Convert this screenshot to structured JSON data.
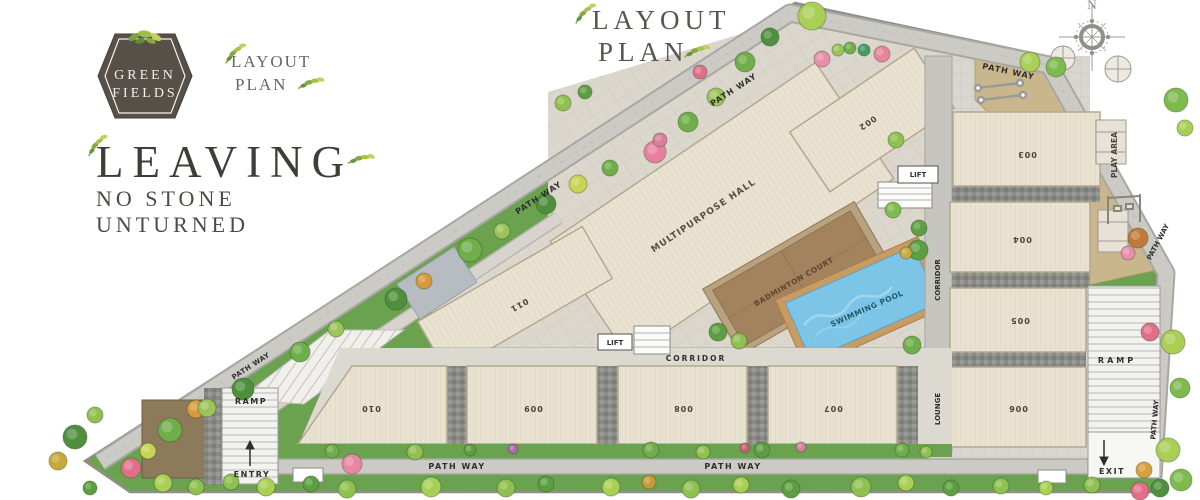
{
  "branding": {
    "logo_line1": "GREEN",
    "logo_line2": "FIELDS",
    "logo_caption_line1": "LAYOUT",
    "logo_caption_line2": "PLAN",
    "main_title_line1": "LAYOUT",
    "main_title_line2": "PLAN",
    "tagline_line1": "LEAVING",
    "tagline_line2": "NO STONE",
    "tagline_line3": "UNTURNED"
  },
  "compass": {
    "north_label": "N"
  },
  "plan": {
    "buildings": {
      "b002": "002",
      "b003": "003",
      "b004": "004",
      "b005": "005",
      "b006": "006",
      "b007": "007",
      "b008": "008",
      "b009": "009",
      "b010": "010",
      "b011": "011"
    },
    "amenities": {
      "multipurpose_hall": "MULTIPURPOSE HALL",
      "badminton_court": "BADMINTON COURT",
      "swimming_pool": "SWIMMING POOL",
      "play_area": "PLAY AREA"
    },
    "circulation": {
      "path_way": "PATH WAY",
      "corridor": "CORRIDOR",
      "lounge": "LOUNGE",
      "lift": "LIFT",
      "ramp": "RAMP",
      "entry": "ENTRY",
      "exit": "EXIT"
    }
  },
  "colors": {
    "grass": "#6aa24f",
    "path": "#cbcac5",
    "building": "#eae2d1",
    "court": "#a3825e",
    "pool": "#7cc5e6",
    "deck": "#c79b62",
    "play_area": "#c9b68c",
    "logo_bg": "#575049",
    "leaf_green": "#7ba33f"
  }
}
